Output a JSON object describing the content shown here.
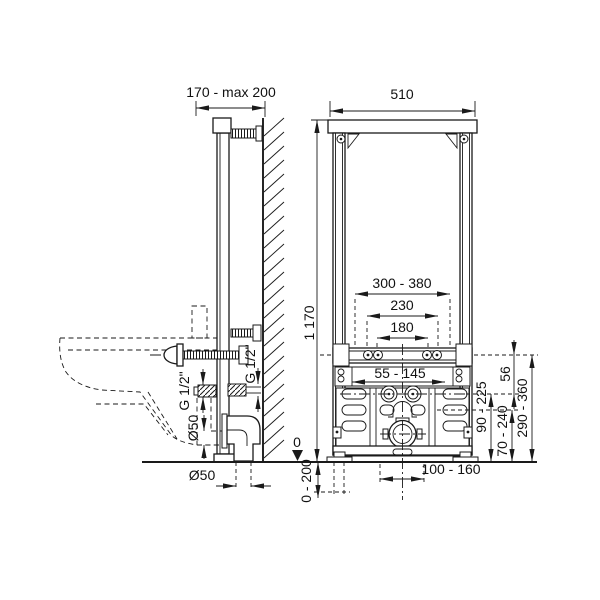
{
  "side_view": {
    "wall_distance": "170 - max 200",
    "datum": "0",
    "leg_extension": "0 - 200",
    "supply_thread_front": "G 1/2\"",
    "supply_thread_rear": "G 1/2\"",
    "drain_pipe_dia": "Ø50",
    "drain_outlet_dia": "Ø50"
  },
  "front_view": {
    "width": "510",
    "height": "1 170",
    "bracket_span": "300 - 380",
    "stud_span_outer": "230",
    "stud_span_inner": "180",
    "plate_range": "55 - 145",
    "rail_to_supply": "56",
    "supply_height": "90 - 225",
    "drain_height": "70 - 240",
    "stud_height": "290 - 360",
    "drain_offset": "100 - 160"
  }
}
